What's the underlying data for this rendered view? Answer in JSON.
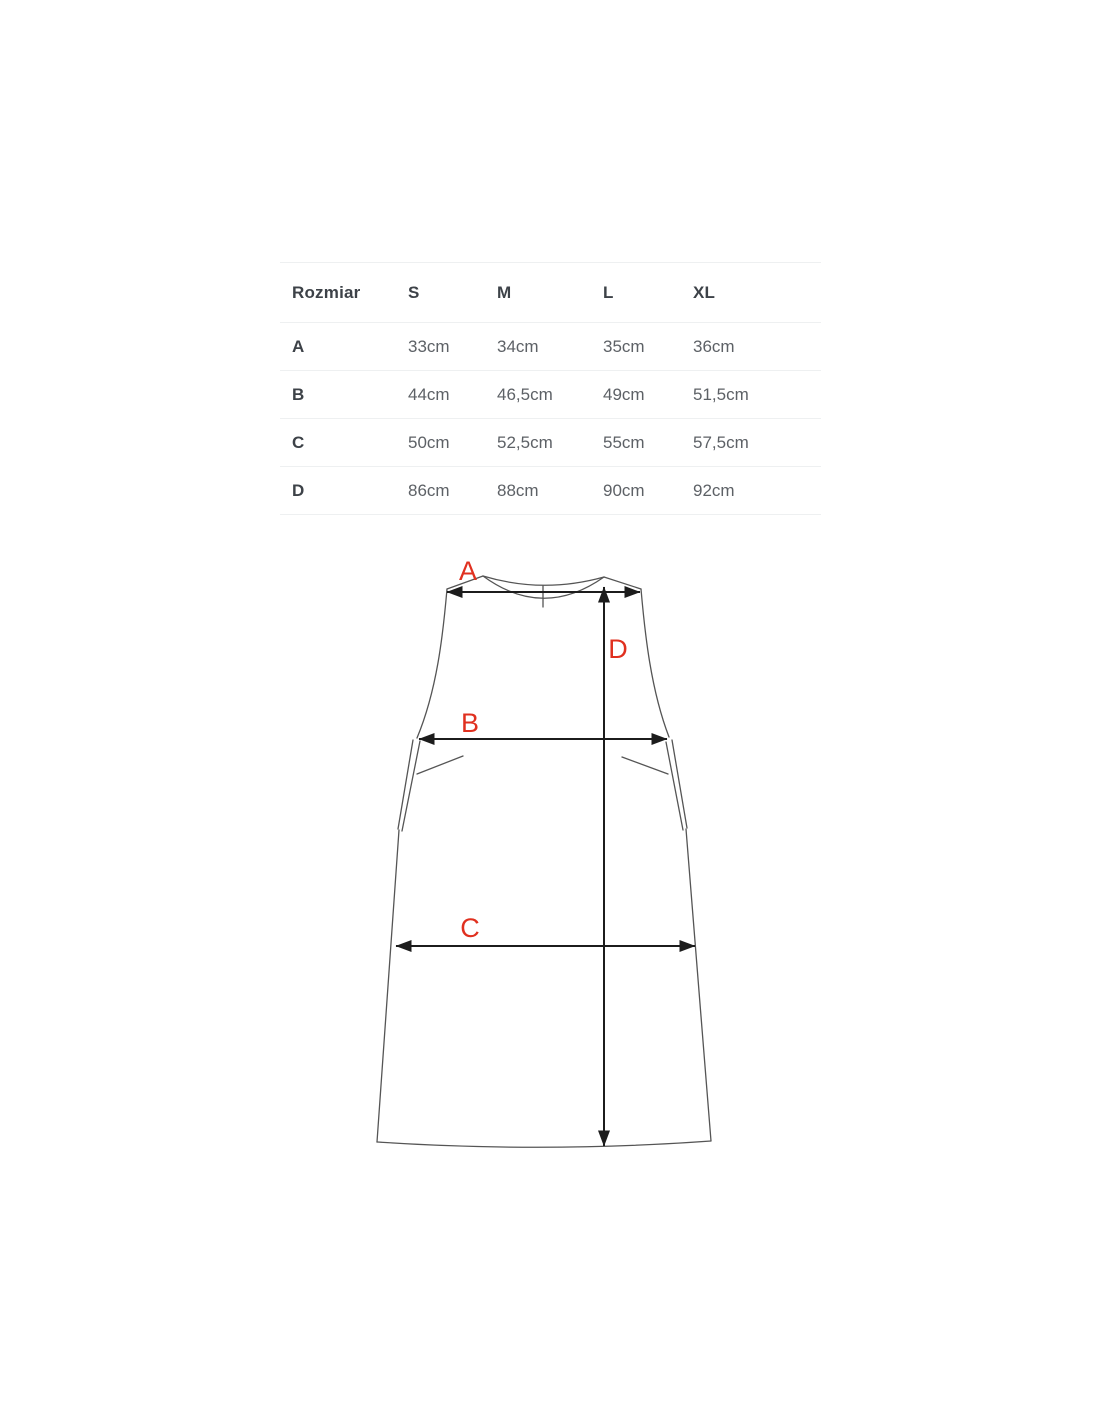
{
  "size_table": {
    "columns": [
      "Rozmiar",
      "S",
      "M",
      "L",
      "XL"
    ],
    "rows": [
      {
        "label": "A",
        "values": [
          "33cm",
          "34cm",
          "35cm",
          "36cm"
        ]
      },
      {
        "label": "B",
        "values": [
          "44cm",
          "46,5cm",
          "49cm",
          "51,5cm"
        ]
      },
      {
        "label": "C",
        "values": [
          "50cm",
          "52,5cm",
          "55cm",
          "57,5cm"
        ]
      },
      {
        "label": "D",
        "values": [
          "86cm",
          "88cm",
          "90cm",
          "92cm"
        ]
      }
    ]
  },
  "diagram": {
    "labels": {
      "a": "A",
      "b": "B",
      "c": "C",
      "d": "D"
    },
    "label_color": "#e0301f",
    "outline_color": "#555555",
    "arrow_color": "#1c1c1c"
  }
}
